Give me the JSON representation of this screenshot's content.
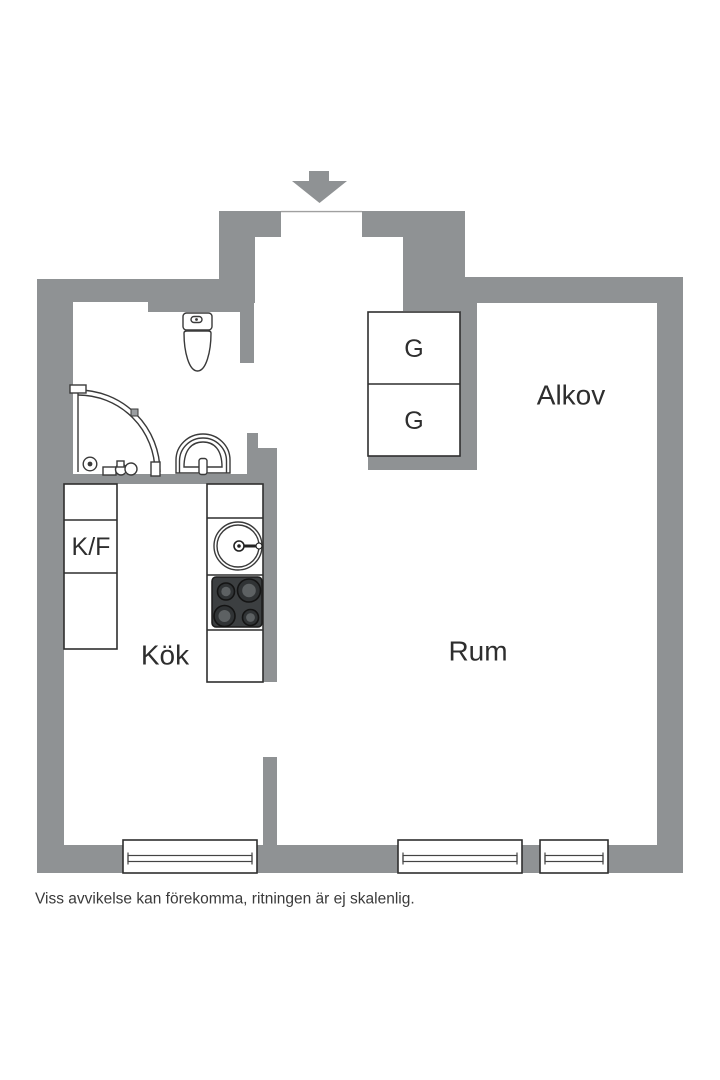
{
  "floor_plan": {
    "labels": {
      "alkov": "Alkov",
      "rum": "Rum",
      "kok": "Kök",
      "kf": "K/F",
      "closet_top": "G",
      "closet_bottom": "G"
    },
    "disclaimer": "Viss avvikelse kan förekomma, ritningen är ej skalenlig.",
    "windows_count": 3,
    "icons": {
      "entrance": "entrance-arrow-down-icon",
      "toilet": "toilet-icon",
      "shower": "corner-shower-icon",
      "bathroom_sink": "washbasin-icon",
      "kitchen_sink": "kitchen-sink-icon",
      "stove": "stove-4-burner-icon"
    },
    "colors": {
      "wall": "#8f9294",
      "line": "#2f2f2f",
      "fixture": "#3a3a3a",
      "stove": "#3c3f41",
      "text": "#2e2e2e",
      "bg": "#ffffff"
    }
  }
}
